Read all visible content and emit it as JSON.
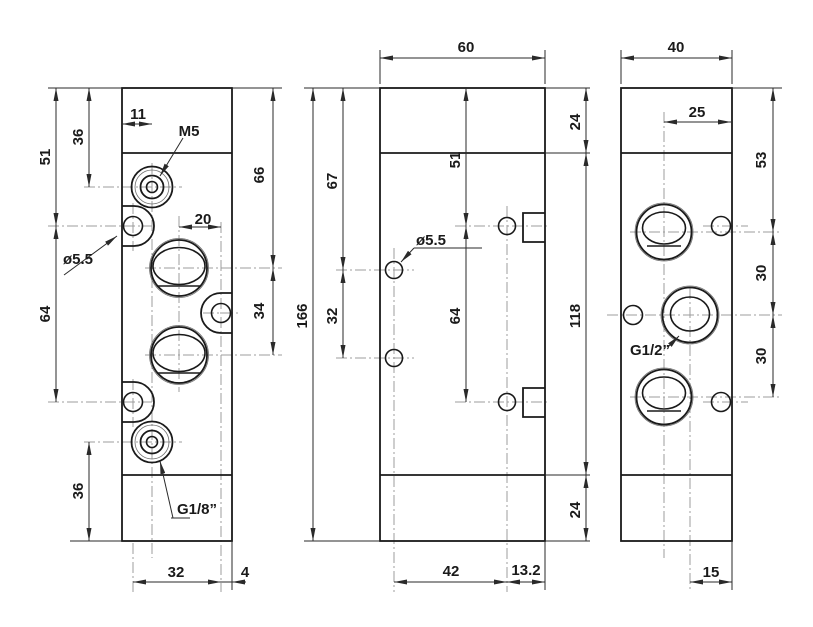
{
  "drawing": {
    "type": "mechanical-dimensioned-drawing",
    "background_color": "#ffffff",
    "line_color": "#1a1a1a",
    "centerline_color": "#9c9c9c",
    "front_view": {
      "dims": {
        "w11": "11",
        "h36_top": "36",
        "h51": "51",
        "h64": "64",
        "h36_bottom": "36",
        "w20": "20",
        "h66": "66",
        "h34": "34",
        "w32": "32",
        "w4": "4"
      },
      "callouts": {
        "thread_top": "M5",
        "hole": "ø5.5",
        "thread_bottom": "G1/8”"
      }
    },
    "side_view": {
      "dims": {
        "w60": "60",
        "h24_top": "24",
        "h67": "67",
        "h166": "166",
        "h32": "32",
        "h51": "51",
        "h64": "64",
        "h118": "118",
        "h24_bottom": "24",
        "w42": "42",
        "w13_2": "13.2"
      },
      "callouts": {
        "hole": "ø5.5"
      }
    },
    "back_view": {
      "dims": {
        "w40": "40",
        "w25": "25",
        "h53": "53",
        "h30_upper": "30",
        "h30_lower": "30",
        "w15": "15"
      },
      "callouts": {
        "thread": "G1/2”"
      }
    }
  }
}
